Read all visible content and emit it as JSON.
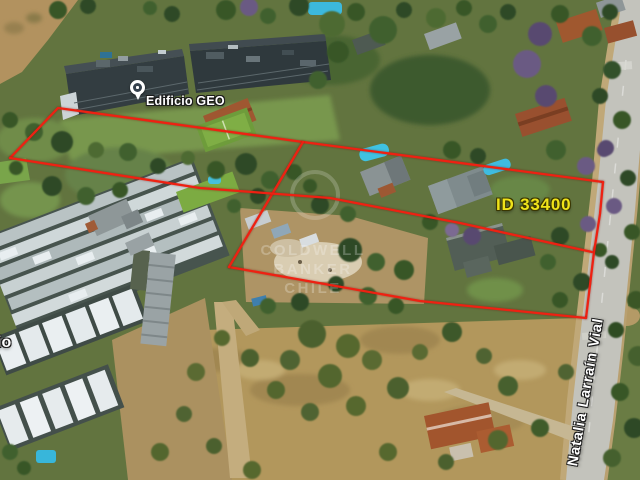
{
  "image": {
    "type": "aerial-property-view",
    "width": 640,
    "height": 480
  },
  "labels": {
    "building_pin": {
      "text": "Edificio GEO"
    },
    "property_id": {
      "text": "ID 33400",
      "color": "#efe31a"
    },
    "street_name": {
      "text": "Natalia Larraín Vial"
    },
    "left_edge_partial": {
      "text": "io"
    }
  },
  "watermark": {
    "lines": [
      "COLDWELL",
      "BANKER",
      "CHILE"
    ]
  },
  "annotations": {
    "boundary_color": "#ee2112",
    "polylines": {
      "north_edge": "10,158 58,108 303,142 603,182",
      "east_edge": "603,182 600,214 594,252 586,318",
      "south_edge": "586,318 420,301 229,267",
      "west_divider": "303,142 229,267",
      "middle_line": "10,158 200,188 330,198 460,223 592,252"
    }
  }
}
